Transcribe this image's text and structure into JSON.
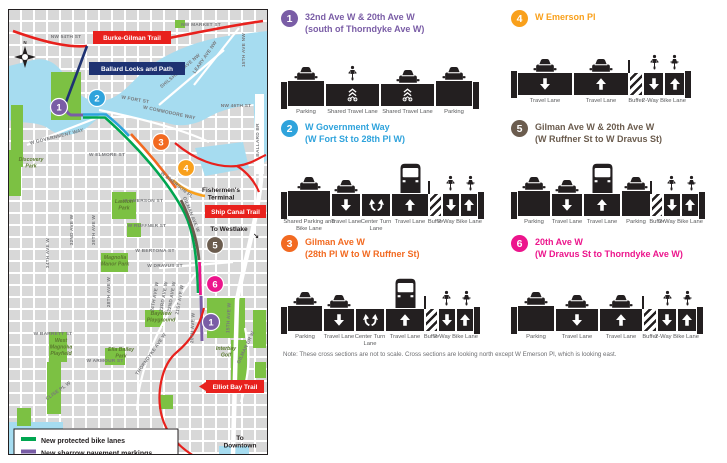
{
  "map": {
    "compass_label": "N",
    "trails": [
      "Burke-Gilman Trail",
      "Ballard Locks and Path",
      "Ship Canal Trail",
      "Elliot Bay Trail"
    ],
    "streets": [
      "NW MARKET ST",
      "NW 54TH ST",
      "LEARY AVE NW",
      "SHILSHOLE AVE NW",
      "15TH AVE NW",
      "NW 46TH ST",
      "BALLARD BR",
      "W FORT ST",
      "W COMMODORE WAY",
      "W GOVERNMENT WAY",
      "W ELMORE ST",
      "W EMERSON ST",
      "W EMERSON PL",
      "GILMAN AVE W",
      "W RUFFNER ST",
      "W BERTONA ST",
      "W DRAVUS ST",
      "W BARRETT ST",
      "W ARMOUR ST",
      "32ND AVE W",
      "30TH AVE W",
      "34TH AVE W",
      "28TH AVE W",
      "24TH AVE W",
      "23RD AVE W",
      "22ND AVE W",
      "21ST AVE W",
      "20TH AVE W",
      "THORNDYKE AVE W",
      "15TH AVE W",
      "GILMAN DR W",
      "CLISE PL W"
    ],
    "parks": [
      [
        "Discovery",
        "Park"
      ],
      [
        "Lawton",
        "Park"
      ],
      [
        "Magnolia",
        "Manor Park"
      ],
      [
        "West",
        "Magnolia",
        "Playfield"
      ],
      [
        "Bayview",
        "Playground"
      ],
      [
        "Ella Bailey",
        "Park"
      ],
      [
        "Interbay",
        "Golf"
      ]
    ],
    "poi": {
      "fishermens": [
        "Fishermen's",
        "Terminal"
      ],
      "westlake": "To Westlake",
      "downtown": [
        "To",
        "Downtown"
      ]
    },
    "markers": [
      {
        "n": "1",
        "color": "#7a5da6"
      },
      {
        "n": "2",
        "color": "#2fa3dc"
      },
      {
        "n": "3",
        "color": "#f26a21"
      },
      {
        "n": "4",
        "color": "#f9a01b"
      },
      {
        "n": "5",
        "color": "#6b5c4e"
      },
      {
        "n": "6",
        "color": "#ec158c"
      },
      {
        "n": "1",
        "color": "#7a5da6"
      }
    ],
    "legend": [
      {
        "label": "New protected bike lanes",
        "swatch": "#00a650"
      },
      {
        "label": "New sharrow pavement markings",
        "swatch": "#7a5da6"
      }
    ]
  },
  "sections": [
    {
      "number": "1",
      "color": "#7a5da6",
      "t1": "32nd Ave W & 20th Ave W",
      "t2": "(south of Thorndyke Ave W)",
      "lanes": [
        {
          "label": "Parking",
          "icon": "car",
          "mark": "",
          "w": 38,
          "kind": "parking"
        },
        {
          "label": "Shared Travel Lane",
          "icon": "bike",
          "mark": "sharrow",
          "w": 55
        },
        {
          "label": "Shared Travel Lane",
          "icon": "car",
          "mark": "sharrow",
          "w": 55
        },
        {
          "label": "Parking",
          "icon": "car",
          "mark": "",
          "w": 38,
          "kind": "parking"
        }
      ]
    },
    {
      "number": "2",
      "color": "#2fa3dc",
      "t1": "W Government Way",
      "t2": "(W Fort St to 28th Pl W)",
      "lanes": [
        {
          "label": "Shared Parking and Bike Lane",
          "icon": "car",
          "mark": "",
          "w": 44,
          "kind": "parking"
        },
        {
          "label": "Travel Lane",
          "icon": "car",
          "mark": "down",
          "w": 30
        },
        {
          "label": "Center Turn Lane",
          "icon": "",
          "mark": "turn",
          "w": 30
        },
        {
          "label": "Travel Lane",
          "icon": "bus",
          "mark": "up",
          "w": 38
        },
        {
          "label": "Buffer",
          "icon": "",
          "mark": "hatch",
          "w": 13,
          "post": true
        },
        {
          "label": "2-Way Bike Lane",
          "icon": "bike2",
          "mark": "twoway",
          "w": 36
        }
      ]
    },
    {
      "number": "3",
      "color": "#f26a21",
      "t1": "Gilman Ave W",
      "t2": "(28th Pl W to W Ruffner St)",
      "lanes": [
        {
          "label": "Parking",
          "icon": "car",
          "mark": "",
          "w": 36,
          "kind": "parking"
        },
        {
          "label": "Travel Lane",
          "icon": "car",
          "mark": "down",
          "w": 32
        },
        {
          "label": "Center Turn Lane",
          "icon": "",
          "mark": "turn",
          "w": 30
        },
        {
          "label": "Travel Lane",
          "icon": "bus",
          "mark": "up",
          "w": 40
        },
        {
          "label": "Buffer",
          "icon": "",
          "mark": "hatch",
          "w": 13,
          "post": true
        },
        {
          "label": "2-Way Bike Lane",
          "icon": "bike2",
          "mark": "twoway",
          "w": 36
        }
      ]
    },
    {
      "number": "4",
      "color": "#f9a01b",
      "t1": "W Emerson Pl",
      "t2": "",
      "lanes": [
        {
          "label": "Travel Lane",
          "icon": "car",
          "mark": "down",
          "w": 56
        },
        {
          "label": "Travel Lane",
          "icon": "car",
          "mark": "up",
          "w": 56
        },
        {
          "label": "Buffer",
          "icon": "",
          "mark": "hatch",
          "w": 14,
          "post": true
        },
        {
          "label": "2-Way Bike Lane",
          "icon": "bike2",
          "mark": "twoway",
          "w": 42
        }
      ]
    },
    {
      "number": "5",
      "color": "#6b5c4e",
      "t1": "Gilman Ave W & 20th Ave W",
      "t2": "(W Ruffner St to W Dravus St)",
      "lanes": [
        {
          "label": "Parking",
          "icon": "car",
          "mark": "",
          "w": 34,
          "kind": "parking"
        },
        {
          "label": "Travel Lane",
          "icon": "car",
          "mark": "down",
          "w": 32
        },
        {
          "label": "Travel Lane",
          "icon": "bus",
          "mark": "up",
          "w": 38
        },
        {
          "label": "Parking",
          "icon": "car",
          "mark": "",
          "w": 30,
          "kind": "parking"
        },
        {
          "label": "Buffer",
          "icon": "",
          "mark": "hatch",
          "w": 12,
          "post": true
        },
        {
          "label": "2-Way Bike Lane",
          "icon": "bike2",
          "mark": "twoway",
          "w": 36
        }
      ]
    },
    {
      "number": "6",
      "color": "#ec158c",
      "t1": "20th Ave W",
      "t2": "(W Dravus St to Thorndyke Ave W)",
      "lanes": [
        {
          "label": "Parking",
          "icon": "car",
          "mark": "",
          "w": 38,
          "kind": "parking"
        },
        {
          "label": "Travel Lane",
          "icon": "car",
          "mark": "down",
          "w": 44
        },
        {
          "label": "Travel Lane",
          "icon": "car",
          "mark": "up",
          "w": 44
        },
        {
          "label": "Buffer",
          "icon": "",
          "mark": "hatch",
          "w": 14,
          "post": true
        },
        {
          "label": "2-Way Bike Lane",
          "icon": "bike2",
          "mark": "twoway",
          "w": 40
        }
      ]
    }
  ],
  "note": "Note: These cross sections are not to scale. Cross sections are looking north except W Emerson Pl, which is looking east."
}
